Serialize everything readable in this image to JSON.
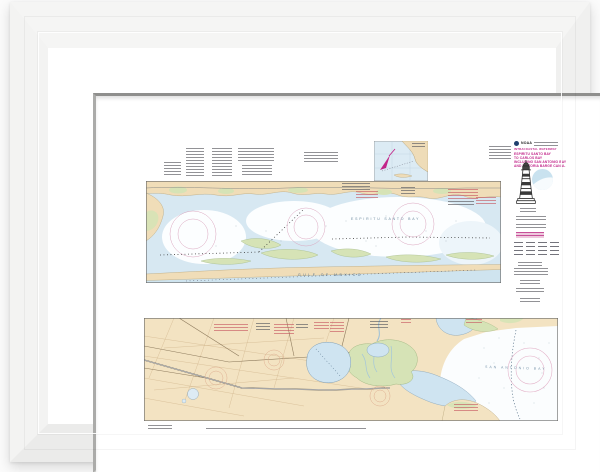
{
  "product": {
    "name": "framed nautical chart print",
    "frame_color": "#f5f5f4",
    "mat_color": "#ffffff",
    "background_color": "#fbfbfb"
  },
  "title_block": {
    "agency_logo": "NOAA",
    "kicker": "INTRACOASTAL WATERWAY",
    "title_line_1": "ESPIRITU SANTO BAY",
    "title_line_2": "TO CARLOS BAY",
    "title_line_3": "INCLUDING SAN ANTONIO BAY",
    "title_line_4": "AND VICTORIA BARGE CANAL",
    "title_color": "#c2268a"
  },
  "upper_chart": {
    "water_label": "ESPIRITU SANTO BAY",
    "gulf_label": "GULF OF MEXICO"
  },
  "lower_chart": {
    "water_label": "SAN ANTONIO BAY"
  },
  "palette": {
    "land": "#f0ddb8",
    "shallow_water": "#d3e6f1",
    "marsh": "#d6e3b6",
    "gulf_water": "#cfe4ef",
    "compass_rose_magenta": "#dba6bf",
    "chart_accent_magenta": "#c2268a"
  }
}
